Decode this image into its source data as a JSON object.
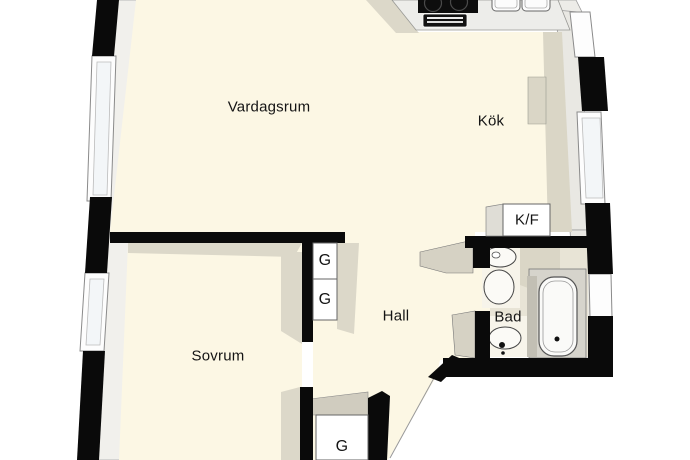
{
  "plan_title": "apartment-floor-plan",
  "rooms": {
    "living": {
      "label": "Vardagsrum"
    },
    "kitchen": {
      "label": "Kök"
    },
    "hall": {
      "label": "Hall"
    },
    "bedroom": {
      "label": "Sovrum"
    },
    "bathroom": {
      "label": "Bad"
    }
  },
  "storage": {
    "wardrobe_hall_upper": {
      "label": "G"
    },
    "wardrobe_hall_lower": {
      "label": "G"
    },
    "wardrobe_entry": {
      "label": "G"
    },
    "fridge_freezer": {
      "label": "K/F"
    }
  },
  "fixtures": {
    "stove": "cooktop with two burners",
    "oven": "oven front",
    "sink": "double kitchen sink",
    "toilet": "toilet",
    "washbasin": "washbasin",
    "bathtub": "bathtub"
  },
  "colors": {
    "floor": "#FCF7E4",
    "shadow": "#DAD6C6",
    "wall": "#0A0A0A",
    "wall_face": "#F1F0EC",
    "counter": "#EDEDEA",
    "window": "#FDFDFD"
  }
}
